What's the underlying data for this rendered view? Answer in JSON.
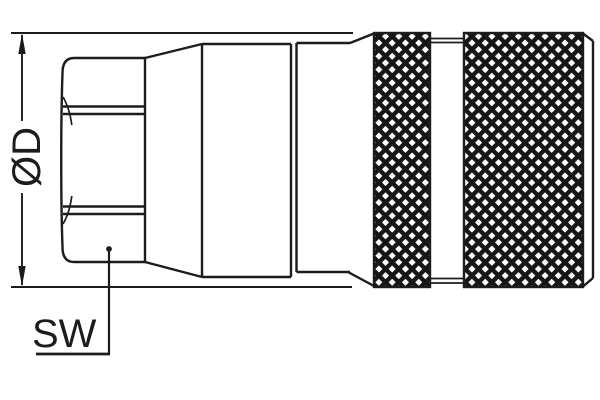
{
  "drawing": {
    "background": "#ffffff",
    "line_color": "#1c1c1c",
    "labels": {
      "diameter": "ØD",
      "wrench_flats": "SW"
    }
  }
}
